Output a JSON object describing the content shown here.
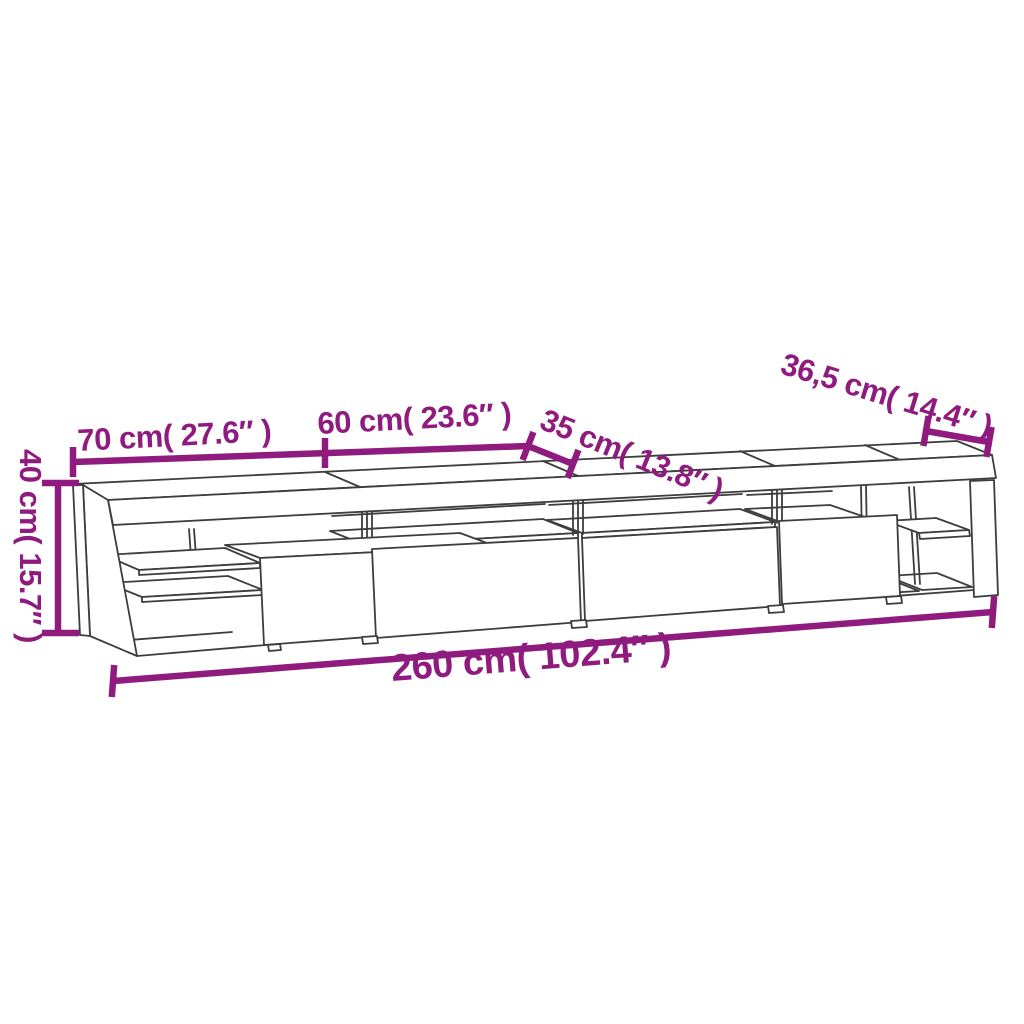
{
  "diagram": {
    "title": "TV cabinet dimension drawing",
    "colors": {
      "dimension_annotation": "#8F1B7F",
      "outline": "#3D3D3D",
      "background": "#FFFFFF"
    },
    "dimensions": {
      "height": {
        "label": "40 cm( 15.7″ )",
        "cm": "40",
        "inches": "15.7"
      },
      "left_section_width": {
        "label": "70 cm( 27.6″ )",
        "cm": "70",
        "inches": "27.6"
      },
      "second_section_width": {
        "label": "60 cm( 23.6″ )",
        "cm": "60",
        "inches": "23.6"
      },
      "depth": {
        "label": "35 cm( 13.8″ )",
        "cm": "35",
        "inches": "13.8"
      },
      "right_compartment_width": {
        "label": "36,5 cm( 14.4″ )",
        "cm": "36,5",
        "inches": "14.4"
      },
      "total_width": {
        "label": "260 cm( 102.4″ )",
        "cm": "260",
        "inches": "102.4"
      }
    }
  }
}
